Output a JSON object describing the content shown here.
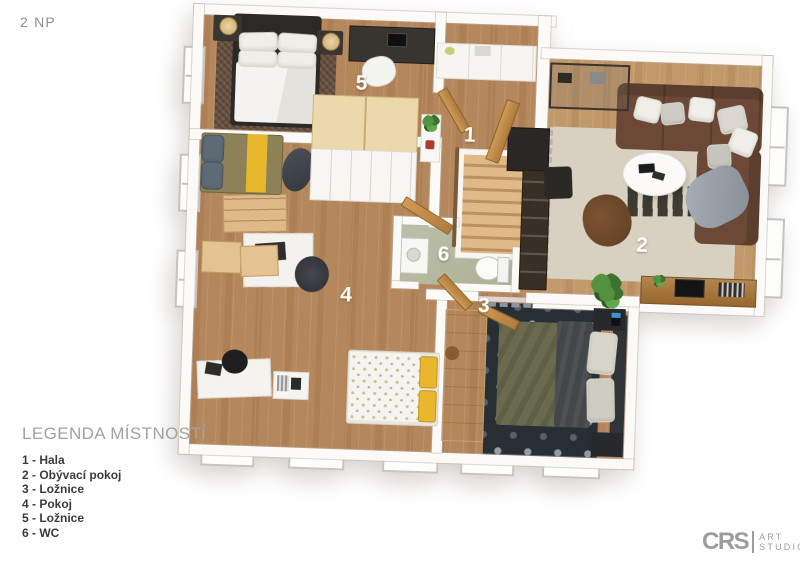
{
  "page": {
    "floor_label": "2 NP",
    "background": "#ffffff"
  },
  "legend": {
    "title": "LEGENDA MÍSTNOSTÍ",
    "items": [
      "1 - Hala",
      "2 - Obývací pokoj",
      "3 - Ložnice",
      "4 - Pokoj",
      "5 - Ložnice",
      "6 - WC"
    ]
  },
  "rooms": {
    "hall": {
      "number": "1",
      "name": "Hala"
    },
    "living": {
      "number": "2",
      "name": "Obývací pokoj"
    },
    "bedroom_right": {
      "number": "3",
      "name": "Ložnice"
    },
    "kids_room": {
      "number": "4",
      "name": "Pokoj"
    },
    "bedroom_left": {
      "number": "5",
      "name": "Ložnice"
    },
    "wc": {
      "number": "6",
      "name": "WC"
    }
  },
  "logo": {
    "brand": "CRS",
    "word1": "ART",
    "word2": "STUDIO"
  },
  "colors": {
    "wall": "#fbfaf7",
    "wood_floor": "#b5875c",
    "living_floor": "#c2996b",
    "wc_floor": "#b6baa5",
    "accent_yellow": "#e9b72e",
    "sofa_brown": "#6b4936",
    "dark_rug": "#272f35",
    "room_number_white": "#ffffff",
    "legend_title_gray": "#a2a2a2",
    "legend_text": "#3b3b3b",
    "logo_gray": "#9d9d9d"
  }
}
